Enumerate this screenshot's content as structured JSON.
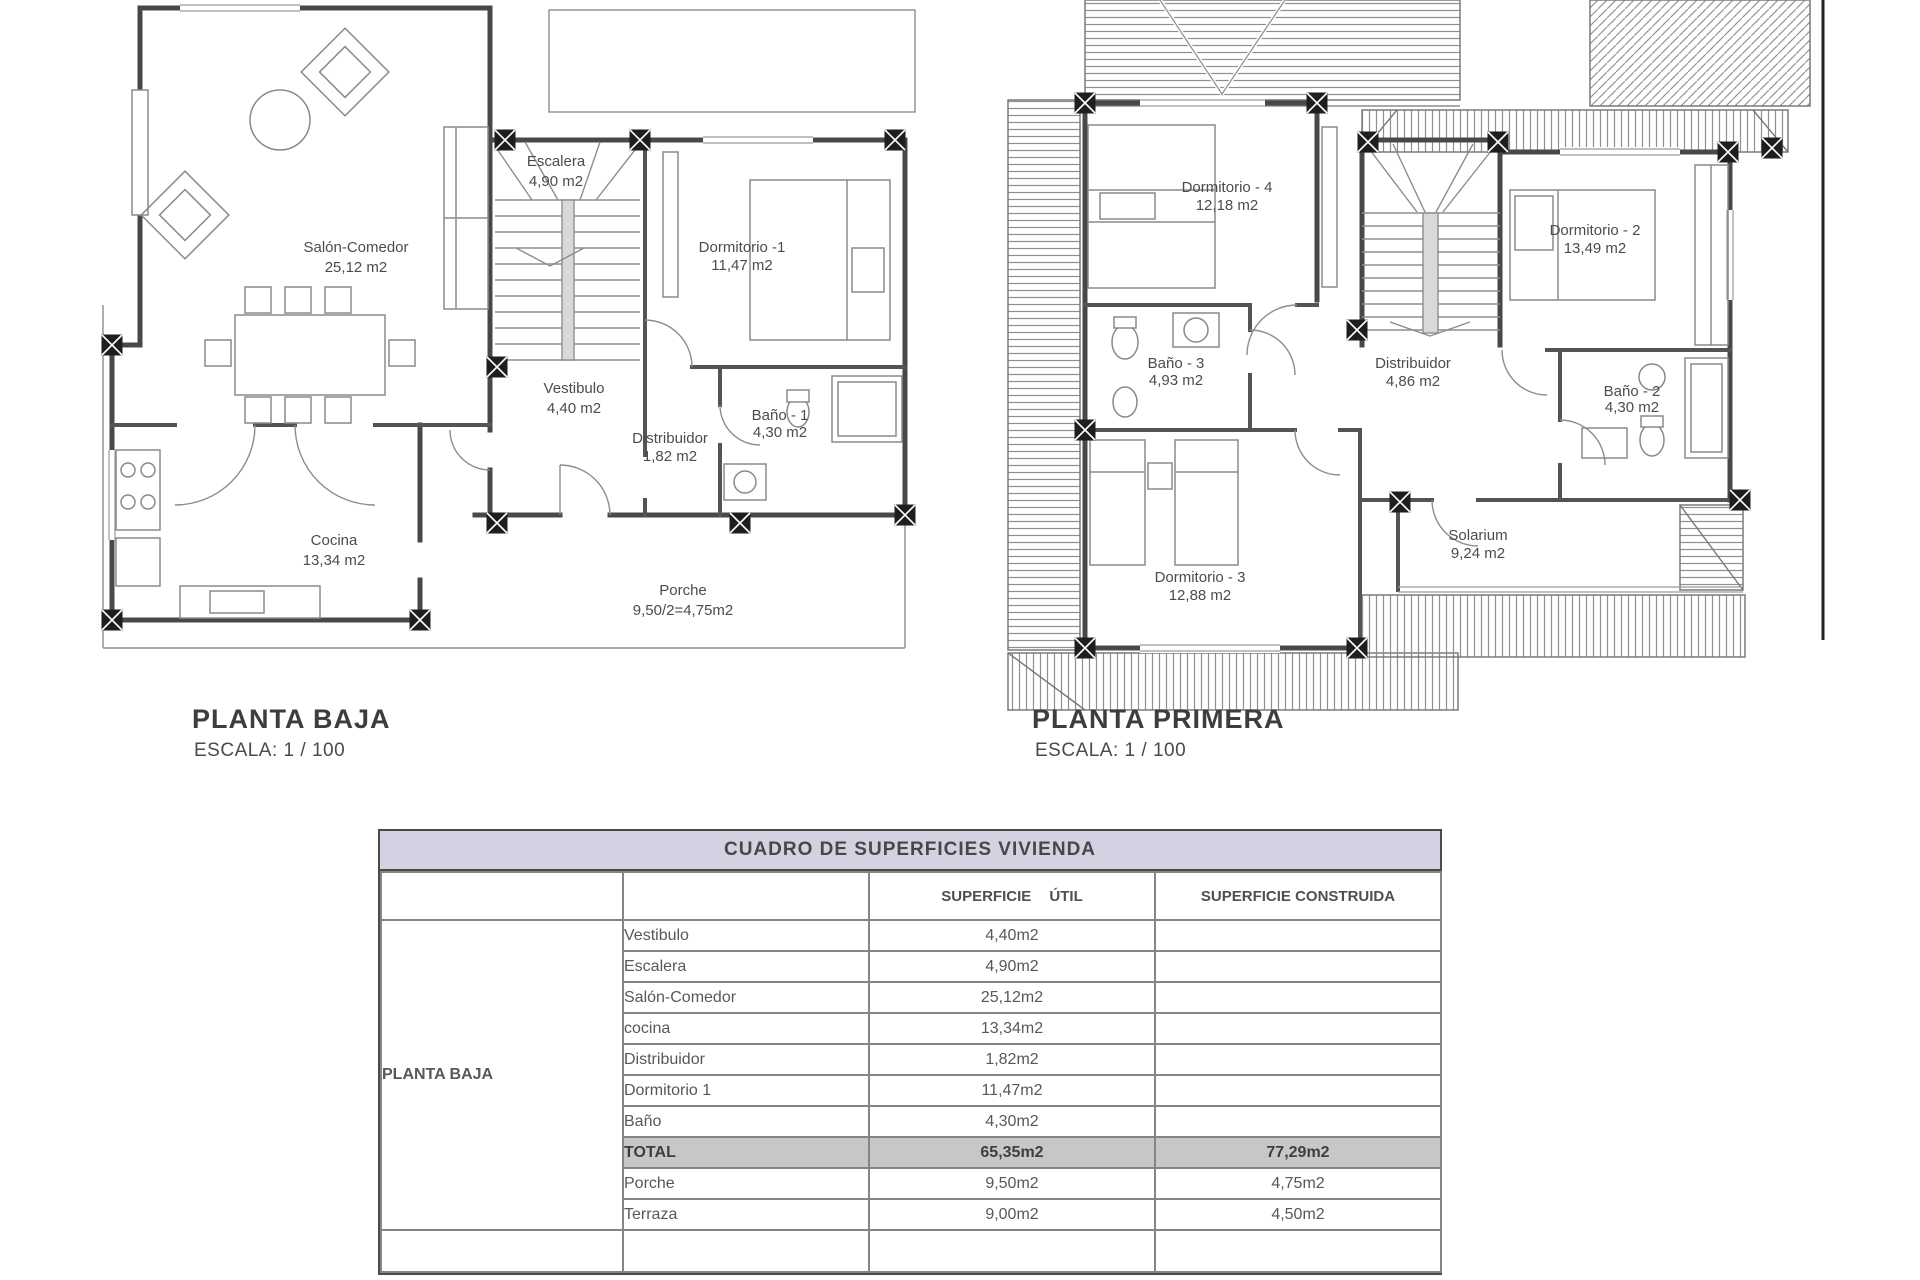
{
  "ground_floor": {
    "title": "PLANTA BAJA",
    "scale": "ESCALA: 1 / 100",
    "rooms": {
      "salon": {
        "name": "Salón-Comedor",
        "area": "25,12 m2"
      },
      "escalera": {
        "name": "Escalera",
        "area": "4,90 m2"
      },
      "dormitorio1": {
        "name": "Dormitorio -1",
        "area": "11,47 m2"
      },
      "vestibulo": {
        "name": "Vestibulo",
        "area": "4,40 m2"
      },
      "distribuidor": {
        "name": "Distribuidor",
        "area": "1,82 m2"
      },
      "bano1": {
        "name": "Baño - 1",
        "area": "4,30 m2"
      },
      "cocina": {
        "name": "Cocina",
        "area": "13,34 m2"
      },
      "porche": {
        "name": "Porche",
        "area": "9,50/2=4,75m2"
      }
    }
  },
  "first_floor": {
    "title": "PLANTA PRIMERA",
    "scale": "ESCALA: 1 / 100",
    "rooms": {
      "dormitorio4": {
        "name": "Dormitorio - 4",
        "area": "12,18 m2"
      },
      "dormitorio2": {
        "name": "Dormitorio - 2",
        "area": "13,49 m2"
      },
      "bano3": {
        "name": "Baño - 3",
        "area": "4,93 m2"
      },
      "distribuidor": {
        "name": "Distribuidor",
        "area": "4,86 m2"
      },
      "bano2": {
        "name": "Baño - 2",
        "area": "4,30 m2"
      },
      "dormitorio3": {
        "name": "Dormitorio - 3",
        "area": "12,88 m2"
      },
      "solarium": {
        "name": "Solarium",
        "area": "9,24 m2"
      }
    }
  },
  "table": {
    "title": "CUADRO DE SUPERFICIES  VIVIENDA",
    "col_util": "SUPERFICIE ÚTIL",
    "col_construida": "SUPERFICIE CONSTRUIDA",
    "group_label": "PLANTA BAJA",
    "rows": [
      {
        "name": "Vestibulo",
        "util": "4,40m2",
        "cons": ""
      },
      {
        "name": "Escalera",
        "util": "4,90m2",
        "cons": ""
      },
      {
        "name": "Salón-Comedor",
        "util": "25,12m2",
        "cons": ""
      },
      {
        "name": "cocina",
        "util": "13,34m2",
        "cons": ""
      },
      {
        "name": "Distribuidor",
        "util": "1,82m2",
        "cons": ""
      },
      {
        "name": "Dormitorio 1",
        "util": "11,47m2",
        "cons": ""
      },
      {
        "name": "Baño",
        "util": "4,30m2",
        "cons": ""
      },
      {
        "name": "TOTAL",
        "util": "65,35m2",
        "cons": "77,29m2"
      },
      {
        "name": "Porche",
        "util": "9,50m2",
        "cons": "4,75m2"
      },
      {
        "name": "Terraza",
        "util": "9,00m2",
        "cons": "4,50m2"
      }
    ],
    "colors": {
      "header_bg": "#d4d1e3",
      "total_row_bg": "#c7c7c7",
      "line": "#484848"
    }
  }
}
